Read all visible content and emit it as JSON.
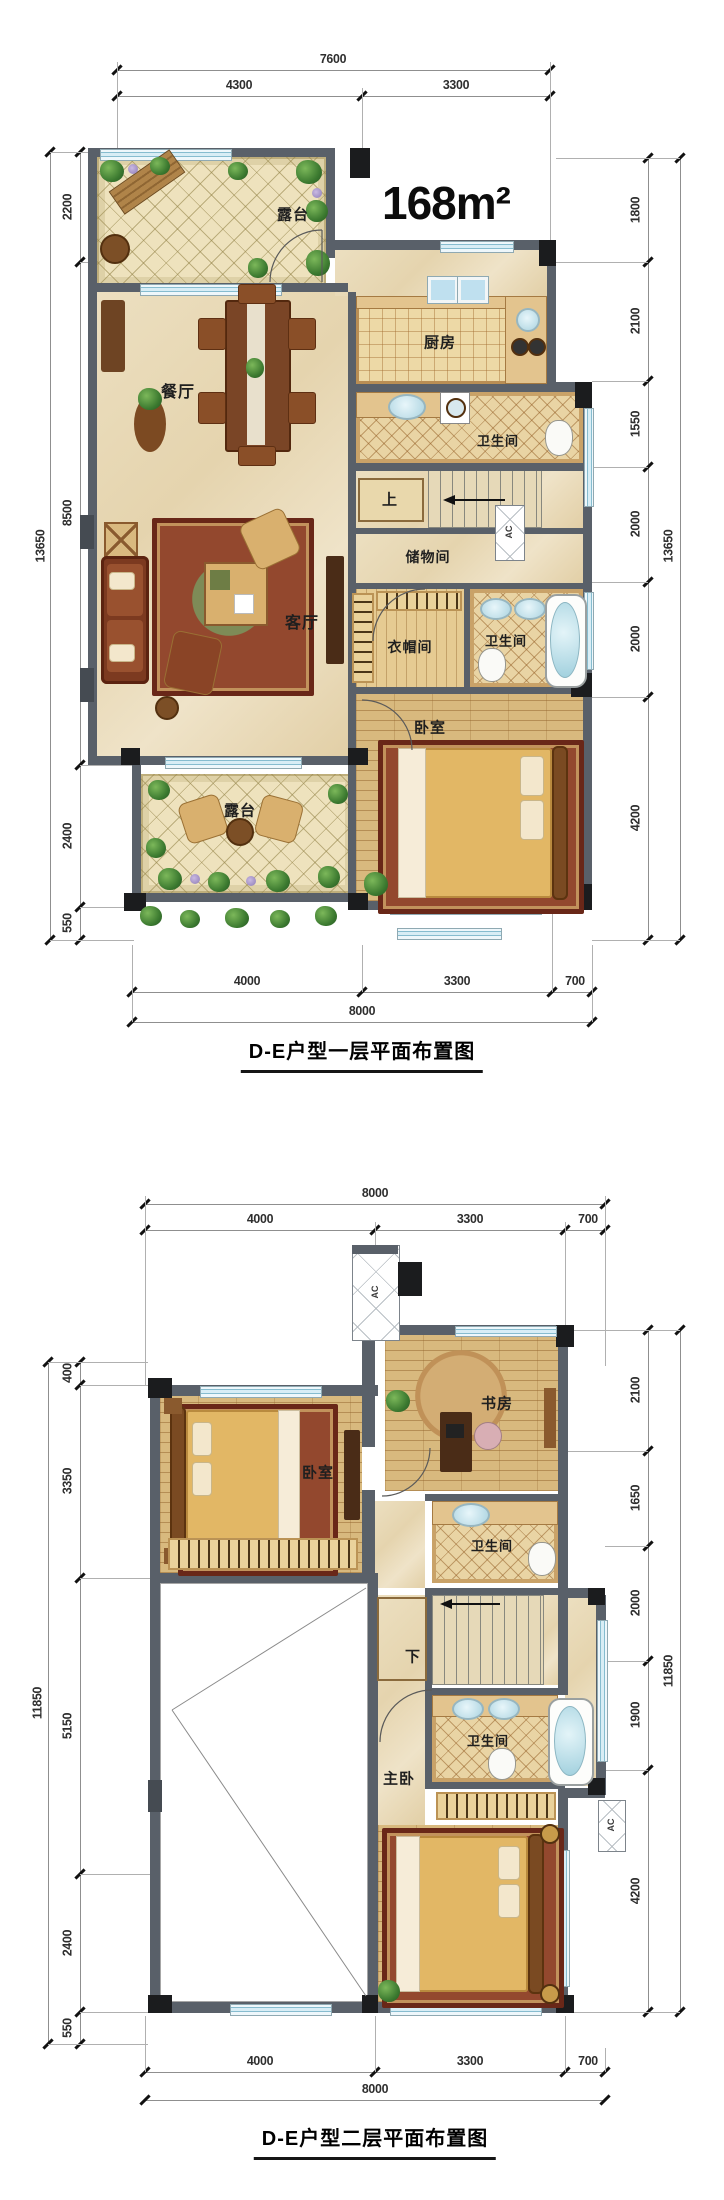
{
  "area_label": "168m²",
  "floor1": {
    "caption": "D-E户型一层平面布置图",
    "ac_label": "AC",
    "rooms": {
      "terrace_top": "露台",
      "dining": "餐厅",
      "kitchen": "厨房",
      "bath_a": "卫生间",
      "stairs_up": "上",
      "storage": "储物间",
      "closet": "衣帽间",
      "living": "客厅",
      "bath_b": "卫生间",
      "bedroom": "卧室",
      "terrace_bottom": "露台"
    },
    "dims": {
      "top_total": "7600",
      "top_segs": [
        "4300",
        "3300"
      ],
      "left_total": "13650",
      "left_segs": [
        "2200",
        "8500",
        "2400",
        "550"
      ],
      "right_total": "13650",
      "right_segs": [
        "1800",
        "2100",
        "1550",
        "2000",
        "2000",
        "4200"
      ],
      "bottom_total": "8000",
      "bottom_segs": [
        "4000",
        "3300",
        "700"
      ]
    }
  },
  "floor2": {
    "caption": "D-E户型二层平面布置图",
    "ac_label": "AC",
    "rooms": {
      "bedroom": "卧室",
      "study": "书房",
      "bath_a": "卫生间",
      "stairs_down": "下",
      "master": "主卧",
      "bath_b": "卫生间"
    },
    "dims": {
      "top_total": "8000",
      "top_segs": [
        "4000",
        "3300",
        "700"
      ],
      "left_total": "11850",
      "left_segs": [
        "400",
        "3350",
        "5150",
        "2400",
        "550"
      ],
      "right_total": "11850",
      "right_segs": [
        "2100",
        "1650",
        "2000",
        "1900",
        "4200"
      ],
      "bottom_total": "8000",
      "bottom_segs": [
        "4000",
        "3300",
        "700"
      ]
    }
  }
}
